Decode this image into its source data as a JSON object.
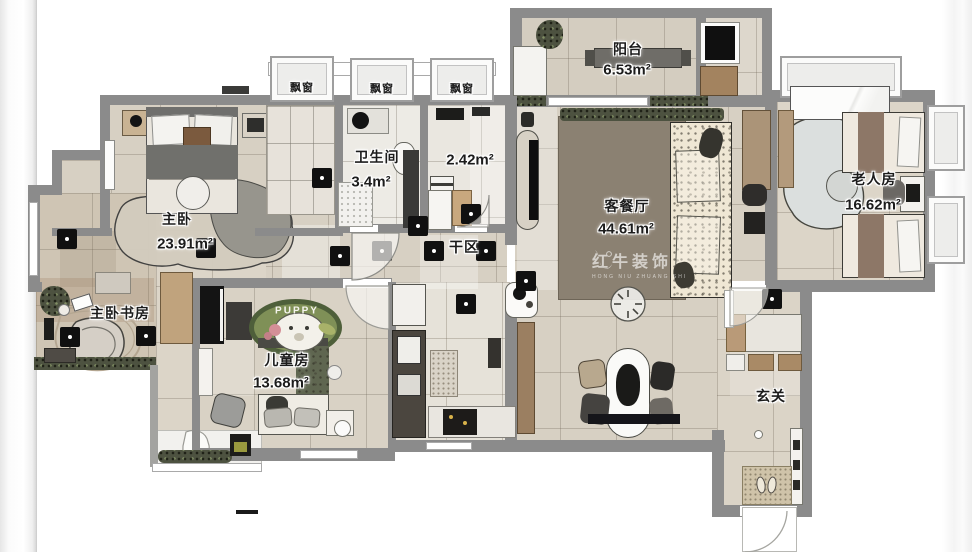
{
  "title": "residential floor plan",
  "rooms": [
    {
      "id": "master",
      "name": "主卧",
      "area": "23.91m²"
    },
    {
      "id": "master_study",
      "name": "主卧书房",
      "area": ""
    },
    {
      "id": "bathroom",
      "name": "卫生间",
      "area": "3.4m²"
    },
    {
      "id": "laundry",
      "name": "",
      "area": "2.42m²"
    },
    {
      "id": "dry_area",
      "name": "干区",
      "area": ""
    },
    {
      "id": "balcony",
      "name": "阳台",
      "area": "6.53m²"
    },
    {
      "id": "living_dining",
      "name": "客餐厅",
      "area": "44.61m²"
    },
    {
      "id": "elder_room",
      "name": "老人房",
      "area": "16.62m²"
    },
    {
      "id": "kids_room",
      "name": "儿童房",
      "area": "13.68m²"
    },
    {
      "id": "foyer",
      "name": "玄关",
      "area": ""
    }
  ],
  "bay_windows": [
    {
      "label": "飘窗"
    },
    {
      "label": "飘窗"
    },
    {
      "label": "飘窗"
    }
  ],
  "kids_rug_text": "PUPPY",
  "watermark": {
    "brand": "红牛装饰",
    "sub": "HONG NIU ZHUANG SHI"
  },
  "colors": {
    "wall": "#8b8b8b",
    "floor": "#d7d0c3",
    "living_rug": "#8b8172",
    "kids_rug": "#7f9057",
    "wood": "#b99a78",
    "marker": "#141414"
  }
}
